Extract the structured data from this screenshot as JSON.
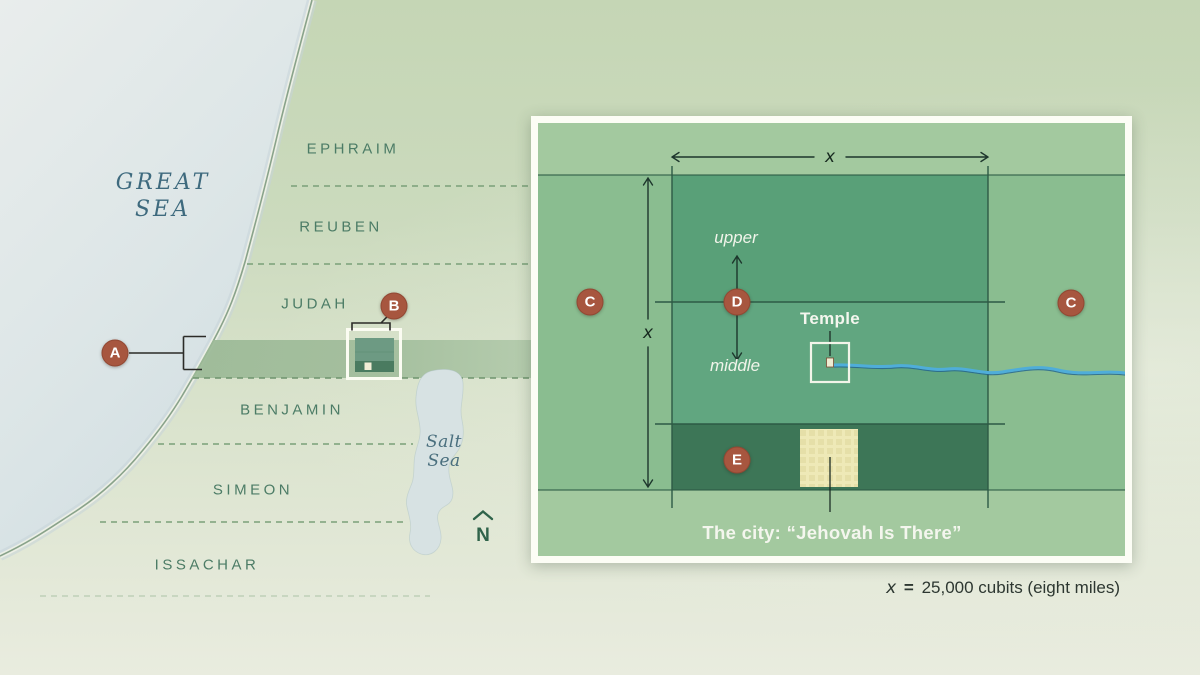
{
  "map": {
    "great_sea": {
      "line1": "GREAT",
      "line2": "SEA"
    },
    "salt_sea": {
      "line1": "Salt",
      "line2": "Sea"
    },
    "territories": [
      {
        "label": "EPHRAIM"
      },
      {
        "label": "REUBEN"
      },
      {
        "label": "JUDAH"
      },
      {
        "label": "BENJAMIN"
      },
      {
        "label": "SIMEON"
      },
      {
        "label": "ISSACHAR"
      }
    ],
    "north": "N",
    "marker_a": "A",
    "marker_b": "B"
  },
  "inset": {
    "badge_c_left": "C",
    "badge_c_right": "C",
    "badge_d": "D",
    "badge_e": "E",
    "label_upper": "upper",
    "label_middle": "middle",
    "label_temple": "Temple",
    "label_city": "The city: “Jehovah Is There”",
    "dim_x_horizontal": "x",
    "dim_x_vertical": "x"
  },
  "caption": {
    "x_symbol": "x",
    "equals": "=",
    "value": "25,000 cubits (eight miles)"
  },
  "colors": {
    "badge": "#a7563f",
    "sea": "#d7e2e4",
    "land_light": "#cbdabd",
    "strip": "#9bb996",
    "inset_band": "#8abd90",
    "inset_square": "#5ea37d",
    "city_strip": "#3d7657",
    "city_square": "#eee9b7",
    "river": "#4fadd9",
    "label_green": "#4c7c66",
    "label_teal": "#3e6a7e"
  }
}
